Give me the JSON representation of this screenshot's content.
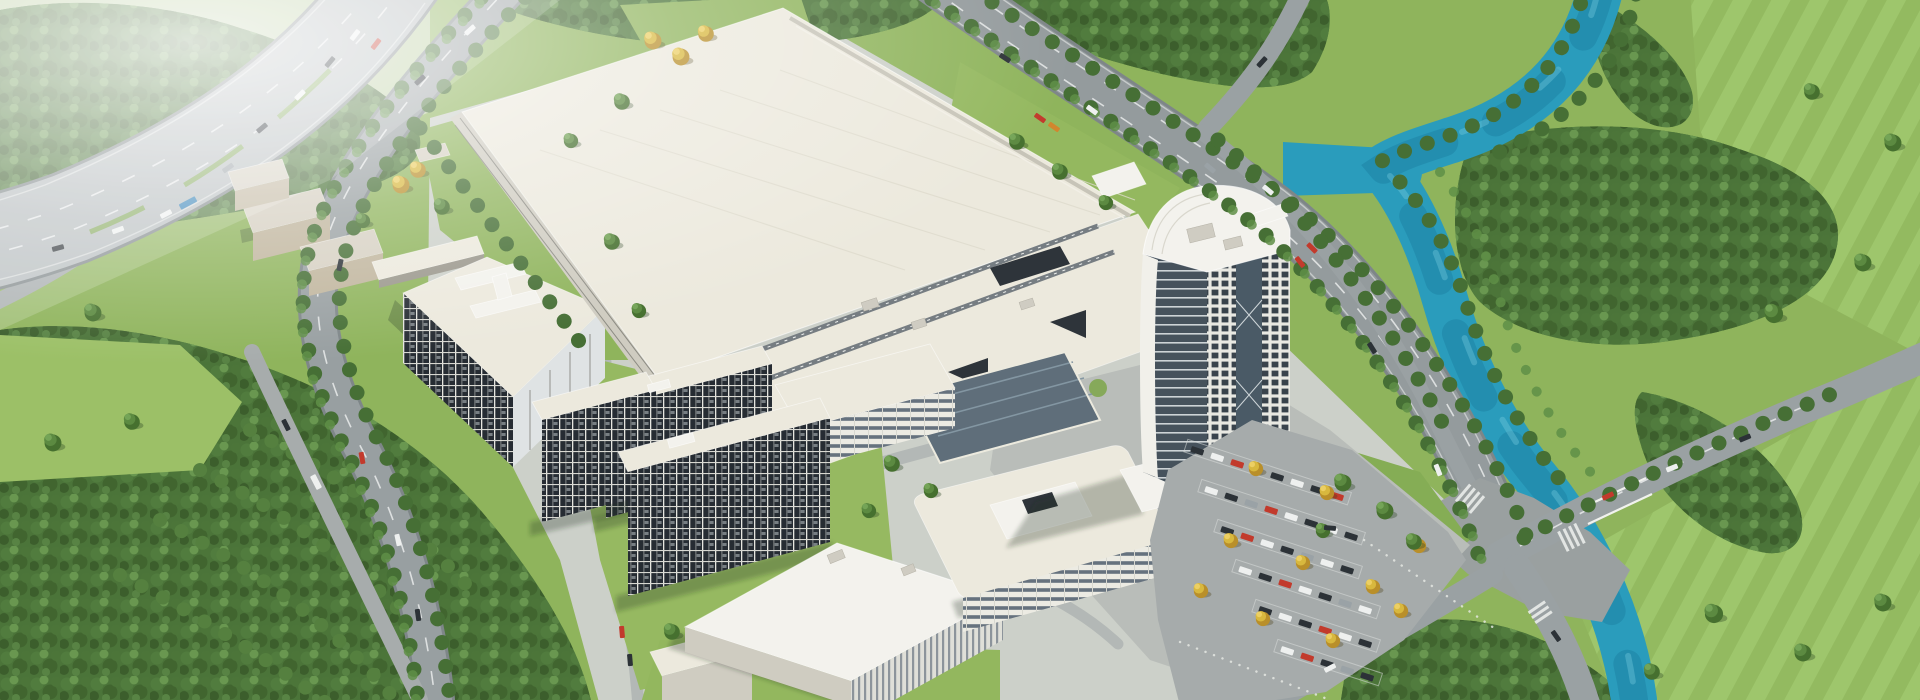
{
  "meta": {
    "description": "Photorealistic aerial bird's-eye CGI rendering of a large industrial campus masterplan",
    "image_text": "none",
    "time_of_day": "daytime, hazy light from upper left"
  },
  "palette": {
    "grass_base": "#8fb45c",
    "grass_light": "#9cc067",
    "grass_pale": "#bccfa2",
    "canopy_dark": "#4b7439",
    "tree_yellow": "#d8b83e",
    "river": "#2a9cbc",
    "river_deep": "#1a7f9f",
    "river_light": "#7fd0e2",
    "highway": "#b6bcbe",
    "road": "#969d9f",
    "road_light": "#aeb3b2",
    "plaza": "#b9bdb9",
    "asphalt": "#a6abab",
    "roof_light": "#ece9dd",
    "roof_white": "#f3f2ed",
    "facade_shade": "#cfccc1",
    "tan_wall": "#c0b59d",
    "window_dark": "#262c33",
    "glass_dark": "#5f6e7a",
    "car_red": "#c23a2c",
    "car_dark": "#2c3237",
    "car_white": "#eef0ef",
    "car_blue": "#2f7fb5",
    "shadow": "rgba(30,45,28,0.28)"
  },
  "scene": {
    "regions": [
      "elevated highway northwest",
      "hazy fields top left",
      "factory mega-roof center",
      "rooftop link corridor",
      "glass atrium hall",
      "high-rise office tower with curved crown",
      "three dormitory slabs",
      "R&D building with I-shaped roof structure",
      "beige utility blocks",
      "exhibition hall",
      "rounded office building",
      "surface parking lot with autumn trees",
      "north boulevard with tree median",
      "west boulevard",
      "turquoise river with Y branch",
      "river bridge road",
      "large road intersection southeast",
      "forest southwest with orchard rows",
      "meadows east of river"
    ],
    "vehicle_colors": [
      "white",
      "dark gray",
      "red",
      "silver",
      "blue bus",
      "orange"
    ]
  }
}
